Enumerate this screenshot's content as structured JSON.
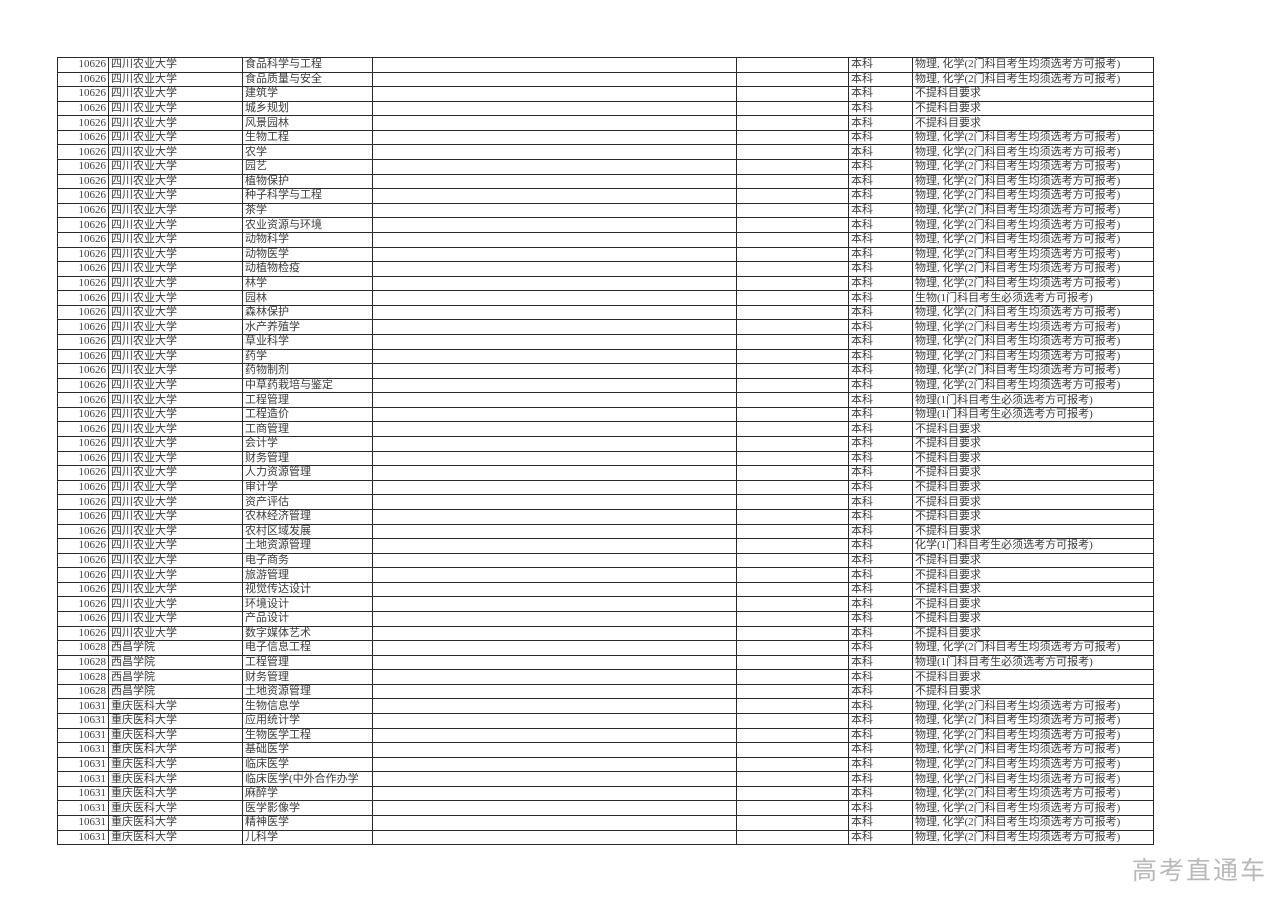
{
  "page": {
    "background_color": "#ffffff",
    "border_color": "#2a2a2a",
    "text_color": "#3c3c3c"
  },
  "watermark": {
    "text": "高考直通车",
    "color": "#b9b9b9"
  },
  "table": {
    "levels": [
      "本科"
    ],
    "requirement_values": [
      "物理, 化学(2门科目考生均须选考方可报考)",
      "不提科目要求",
      "生物(1门科目考生必须选考方可报考)",
      "物理(1门科目考生必须选考方可报考)",
      "化学(1门科目考生必须选考方可报考)"
    ],
    "rows": [
      {
        "code": "10626",
        "university": "四川农业大学",
        "major": "食品科学与工程",
        "level": "本科",
        "requirement": "物理, 化学(2门科目考生均须选考方可报考)"
      },
      {
        "code": "10626",
        "university": "四川农业大学",
        "major": "食品质量与安全",
        "level": "本科",
        "requirement": "物理, 化学(2门科目考生均须选考方可报考)"
      },
      {
        "code": "10626",
        "university": "四川农业大学",
        "major": "建筑学",
        "level": "本科",
        "requirement": "不提科目要求"
      },
      {
        "code": "10626",
        "university": "四川农业大学",
        "major": "城乡规划",
        "level": "本科",
        "requirement": "不提科目要求"
      },
      {
        "code": "10626",
        "university": "四川农业大学",
        "major": "风景园林",
        "level": "本科",
        "requirement": "不提科目要求"
      },
      {
        "code": "10626",
        "university": "四川农业大学",
        "major": "生物工程",
        "level": "本科",
        "requirement": "物理, 化学(2门科目考生均须选考方可报考)"
      },
      {
        "code": "10626",
        "university": "四川农业大学",
        "major": "农学",
        "level": "本科",
        "requirement": "物理, 化学(2门科目考生均须选考方可报考)"
      },
      {
        "code": "10626",
        "university": "四川农业大学",
        "major": "园艺",
        "level": "本科",
        "requirement": "物理, 化学(2门科目考生均须选考方可报考)"
      },
      {
        "code": "10626",
        "university": "四川农业大学",
        "major": "植物保护",
        "level": "本科",
        "requirement": "物理, 化学(2门科目考生均须选考方可报考)"
      },
      {
        "code": "10626",
        "university": "四川农业大学",
        "major": "种子科学与工程",
        "level": "本科",
        "requirement": "物理, 化学(2门科目考生均须选考方可报考)"
      },
      {
        "code": "10626",
        "university": "四川农业大学",
        "major": "茶学",
        "level": "本科",
        "requirement": "物理, 化学(2门科目考生均须选考方可报考)"
      },
      {
        "code": "10626",
        "university": "四川农业大学",
        "major": "农业资源与环境",
        "level": "本科",
        "requirement": "物理, 化学(2门科目考生均须选考方可报考)"
      },
      {
        "code": "10626",
        "university": "四川农业大学",
        "major": "动物科学",
        "level": "本科",
        "requirement": "物理, 化学(2门科目考生均须选考方可报考)"
      },
      {
        "code": "10626",
        "university": "四川农业大学",
        "major": "动物医学",
        "level": "本科",
        "requirement": "物理, 化学(2门科目考生均须选考方可报考)"
      },
      {
        "code": "10626",
        "university": "四川农业大学",
        "major": "动植物检疫",
        "level": "本科",
        "requirement": "物理, 化学(2门科目考生均须选考方可报考)"
      },
      {
        "code": "10626",
        "university": "四川农业大学",
        "major": "林学",
        "level": "本科",
        "requirement": "物理, 化学(2门科目考生均须选考方可报考)"
      },
      {
        "code": "10626",
        "university": "四川农业大学",
        "major": "园林",
        "level": "本科",
        "requirement": "生物(1门科目考生必须选考方可报考)"
      },
      {
        "code": "10626",
        "university": "四川农业大学",
        "major": "森林保护",
        "level": "本科",
        "requirement": "物理, 化学(2门科目考生均须选考方可报考)"
      },
      {
        "code": "10626",
        "university": "四川农业大学",
        "major": "水产养殖学",
        "level": "本科",
        "requirement": "物理, 化学(2门科目考生均须选考方可报考)"
      },
      {
        "code": "10626",
        "university": "四川农业大学",
        "major": "草业科学",
        "level": "本科",
        "requirement": "物理, 化学(2门科目考生均须选考方可报考)"
      },
      {
        "code": "10626",
        "university": "四川农业大学",
        "major": "药学",
        "level": "本科",
        "requirement": "物理, 化学(2门科目考生均须选考方可报考)"
      },
      {
        "code": "10626",
        "university": "四川农业大学",
        "major": "药物制剂",
        "level": "本科",
        "requirement": "物理, 化学(2门科目考生均须选考方可报考)"
      },
      {
        "code": "10626",
        "university": "四川农业大学",
        "major": "中草药栽培与鉴定",
        "level": "本科",
        "requirement": "物理, 化学(2门科目考生均须选考方可报考)"
      },
      {
        "code": "10626",
        "university": "四川农业大学",
        "major": "工程管理",
        "level": "本科",
        "requirement": "物理(1门科目考生必须选考方可报考)"
      },
      {
        "code": "10626",
        "university": "四川农业大学",
        "major": "工程造价",
        "level": "本科",
        "requirement": "物理(1门科目考生必须选考方可报考)"
      },
      {
        "code": "10626",
        "university": "四川农业大学",
        "major": "工商管理",
        "level": "本科",
        "requirement": "不提科目要求"
      },
      {
        "code": "10626",
        "university": "四川农业大学",
        "major": "会计学",
        "level": "本科",
        "requirement": "不提科目要求"
      },
      {
        "code": "10626",
        "university": "四川农业大学",
        "major": "财务管理",
        "level": "本科",
        "requirement": "不提科目要求"
      },
      {
        "code": "10626",
        "university": "四川农业大学",
        "major": "人力资源管理",
        "level": "本科",
        "requirement": "不提科目要求"
      },
      {
        "code": "10626",
        "university": "四川农业大学",
        "major": "审计学",
        "level": "本科",
        "requirement": "不提科目要求"
      },
      {
        "code": "10626",
        "university": "四川农业大学",
        "major": "资产评估",
        "level": "本科",
        "requirement": "不提科目要求"
      },
      {
        "code": "10626",
        "university": "四川农业大学",
        "major": "农林经济管理",
        "level": "本科",
        "requirement": "不提科目要求"
      },
      {
        "code": "10626",
        "university": "四川农业大学",
        "major": "农村区域发展",
        "level": "本科",
        "requirement": "不提科目要求"
      },
      {
        "code": "10626",
        "university": "四川农业大学",
        "major": "土地资源管理",
        "level": "本科",
        "requirement": "化学(1门科目考生必须选考方可报考)"
      },
      {
        "code": "10626",
        "university": "四川农业大学",
        "major": "电子商务",
        "level": "本科",
        "requirement": "不提科目要求"
      },
      {
        "code": "10626",
        "university": "四川农业大学",
        "major": "旅游管理",
        "level": "本科",
        "requirement": "不提科目要求"
      },
      {
        "code": "10626",
        "university": "四川农业大学",
        "major": "视觉传达设计",
        "level": "本科",
        "requirement": "不提科目要求"
      },
      {
        "code": "10626",
        "university": "四川农业大学",
        "major": "环境设计",
        "level": "本科",
        "requirement": "不提科目要求"
      },
      {
        "code": "10626",
        "university": "四川农业大学",
        "major": "产品设计",
        "level": "本科",
        "requirement": "不提科目要求"
      },
      {
        "code": "10626",
        "university": "四川农业大学",
        "major": "数字媒体艺术",
        "level": "本科",
        "requirement": "不提科目要求"
      },
      {
        "code": "10628",
        "university": "西昌学院",
        "major": "电子信息工程",
        "level": "本科",
        "requirement": "物理, 化学(2门科目考生均须选考方可报考)"
      },
      {
        "code": "10628",
        "university": "西昌学院",
        "major": "工程管理",
        "level": "本科",
        "requirement": "物理(1门科目考生必须选考方可报考)"
      },
      {
        "code": "10628",
        "university": "西昌学院",
        "major": "财务管理",
        "level": "本科",
        "requirement": "不提科目要求"
      },
      {
        "code": "10628",
        "university": "西昌学院",
        "major": "土地资源管理",
        "level": "本科",
        "requirement": "不提科目要求"
      },
      {
        "code": "10631",
        "university": "重庆医科大学",
        "major": "生物信息学",
        "level": "本科",
        "requirement": "物理, 化学(2门科目考生均须选考方可报考)"
      },
      {
        "code": "10631",
        "university": "重庆医科大学",
        "major": "应用统计学",
        "level": "本科",
        "requirement": "物理, 化学(2门科目考生均须选考方可报考)"
      },
      {
        "code": "10631",
        "university": "重庆医科大学",
        "major": "生物医学工程",
        "level": "本科",
        "requirement": "物理, 化学(2门科目考生均须选考方可报考)"
      },
      {
        "code": "10631",
        "university": "重庆医科大学",
        "major": "基础医学",
        "level": "本科",
        "requirement": "物理, 化学(2门科目考生均须选考方可报考)"
      },
      {
        "code": "10631",
        "university": "重庆医科大学",
        "major": "临床医学",
        "level": "本科",
        "requirement": "物理, 化学(2门科目考生均须选考方可报考)"
      },
      {
        "code": "10631",
        "university": "重庆医科大学",
        "major": "临床医学(中外合作办学",
        "level": "本科",
        "requirement": "物理, 化学(2门科目考生均须选考方可报考)"
      },
      {
        "code": "10631",
        "university": "重庆医科大学",
        "major": "麻醉学",
        "level": "本科",
        "requirement": "物理, 化学(2门科目考生均须选考方可报考)"
      },
      {
        "code": "10631",
        "university": "重庆医科大学",
        "major": "医学影像学",
        "level": "本科",
        "requirement": "物理, 化学(2门科目考生均须选考方可报考)"
      },
      {
        "code": "10631",
        "university": "重庆医科大学",
        "major": "精神医学",
        "level": "本科",
        "requirement": "物理, 化学(2门科目考生均须选考方可报考)"
      },
      {
        "code": "10631",
        "university": "重庆医科大学",
        "major": "儿科学",
        "level": "本科",
        "requirement": "物理, 化学(2门科目考生均须选考方可报考)"
      }
    ]
  }
}
